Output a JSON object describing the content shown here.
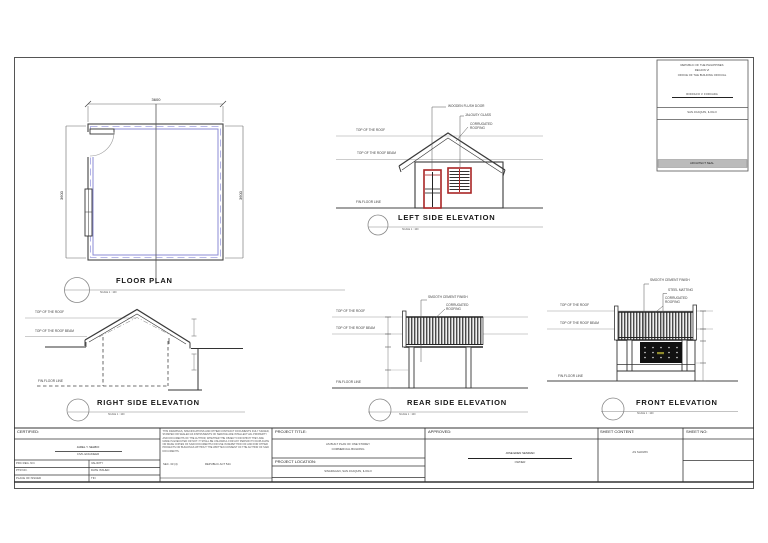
{
  "header_block": {
    "line1": "REPUBLIC OF THE PHILIPPINES",
    "line2": "REGION VI",
    "line3": "OFFICE OF THE BUILDING OFFICIAL",
    "official_name": "RODOLFO V. FORCADA",
    "location": "SAN JOAQUIN, ILOILO",
    "seal_label": "ARCHITECT SEAL"
  },
  "floor_plan": {
    "title": "FLOOR PLAN",
    "scale": "SCALE 1 : 100",
    "dim_top": "3600",
    "dim_left": "3600",
    "dim_right": "3600"
  },
  "left_elevation": {
    "title": "LEFT SIDE ELEVATION",
    "scale": "SCALE 1 : 100",
    "callout_door": "WOODEN FLUSH DOOR",
    "callout_glass": "JALOUSY GLASS",
    "callout_roof": "CORRUGATED ROOFING",
    "ref_roof": "TOP OF THE ROOF",
    "ref_beam": "TOP OF THE ROOF BEAM",
    "ref_floor": "FIN.FLOOR LINE"
  },
  "right_elevation": {
    "title": "RIGHT SIDE ELEVATION",
    "scale": "SCALE 1 : 100",
    "ref_roof": "TOP OF THE ROOF",
    "ref_beam": "TOP OF THE ROOF BEAM",
    "ref_floor": "FIN.FLOOR LINE"
  },
  "rear_elevation": {
    "title": "REAR SIDE ELEVATION",
    "scale": "SCALE 1 : 100",
    "callout_cement": "SMOOTH CEMENT FINISH",
    "callout_roof": "CORRUGATED ROOFING",
    "ref_roof": "TOP OF THE ROOF",
    "ref_beam": "TOP OF THE ROOF BEAM",
    "ref_floor": "FIN.FLOOR LINE"
  },
  "front_elevation": {
    "title": "FRONT ELEVATION",
    "scale": "SCALE 1 : 100",
    "callout_cement": "SMOOTH CEMENT FINISH",
    "callout_matting": "STEEL MATTING",
    "callout_roof": "CORRUGATED ROOFING",
    "ref_roof": "TOP OF THE ROOF",
    "ref_beam": "TOP OF THE ROOF BEAM",
    "ref_floor": "FIN.FLOOR LINE"
  },
  "title_block": {
    "certified": {
      "label": "CERTIFIED:",
      "name": "JAREL Y. SELBIO",
      "role": "CIVIL ENGINEER",
      "fields": [
        {
          "left": "PRC REG. NO.",
          "right": "VALIDITY"
        },
        {
          "left": "PTR NO.",
          "right": "DATE ISSUED"
        },
        {
          "left": "PLACE OF ISSUED",
          "right": "TIN"
        }
      ]
    },
    "disclaimer": {
      "text": "THIS DRAWINGS, SPECIFICATIONS AND OTHER CONTRACT DOCUMENTS DULY SIGNED, STAMPED OR SEALED AS INSTRUMENTS OF SERVICE ARE INTELLECTUAL PROPERTY AND DOCUMENTS OF THE AUTHOR, WHETHER THE OBJECT FOR WHICH THEY ARE MADE IS EXECUTED OR NOT. IT SHALL BE UNLAWFUL FOR ANY PERSON TO DUPLICATE OR MAKE COPIES OF SAID DOCUMENTS FOR USE IN REPETITION OF AND FOR OTHER PROJECTS OR BUILDINGS WITHOUT THE WRITTEN CONSENT OF THE AUTHOR OF SAID DOCUMENTS.",
      "section": "SEC. 33 (4)",
      "act": "REPUBLIC ACT 544"
    },
    "project_title": {
      "label": "PROJECT TITLE:",
      "line1": "AS BUILT PLAN OF ONE STOREY",
      "line2": "COMMERCIAL BUILDING"
    },
    "project_location": {
      "label": "PROJECT LOCATION:",
      "value": "SINARAGAN, SAN JOAQUIN, ILOILO"
    },
    "approved": {
      "label": "APPROVED:",
      "name": "JOSE EDEN SENIDAD",
      "role": "OWNER"
    },
    "sheet_content": {
      "label": "SHEET CONTENT:",
      "value": "AS SHOWN"
    },
    "sheet_no": {
      "label": "SHEET NO:"
    }
  },
  "colors": {
    "line": "#3a3a3a",
    "ref_line": "#999999",
    "wall_blue": "#8b8bd6",
    "opening_red": "#a82525",
    "panel_black": "#111111",
    "seal_band_gray": "#bbbbbb"
  }
}
